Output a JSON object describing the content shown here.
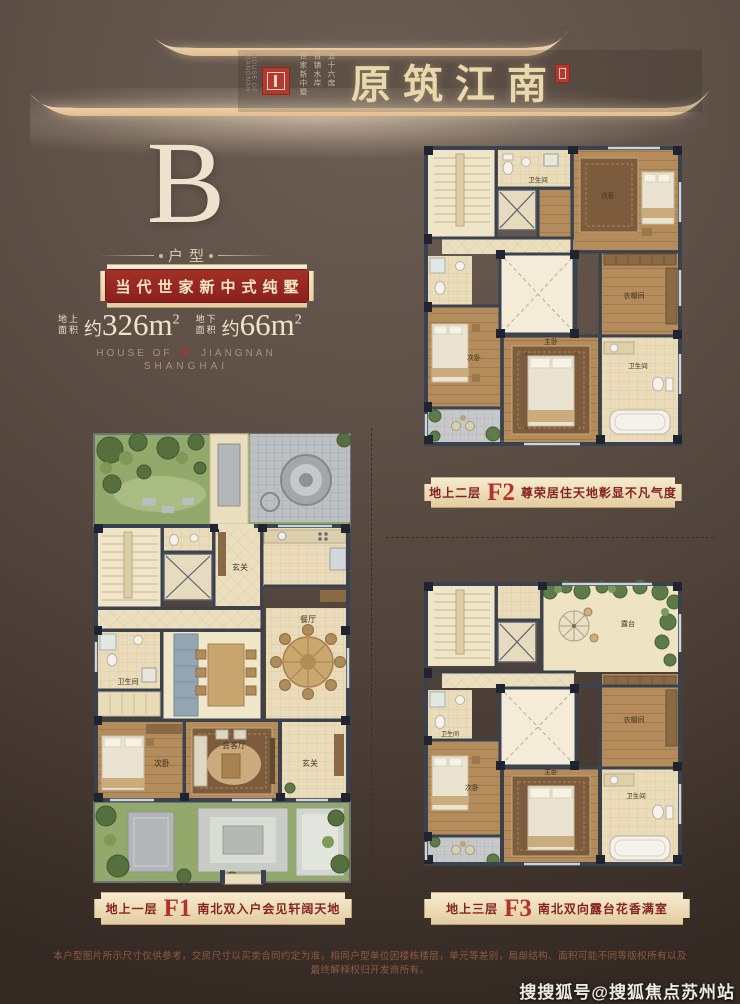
{
  "header": {
    "brand_en_vertical": "HOUSE OF JIANGNAN",
    "tagline_columns": [
      "五十六席",
      "古镇水岸",
      "世家新中墅"
    ],
    "title": "原筑江南"
  },
  "type_section": {
    "letter": "B",
    "label": "户型",
    "slogan": "当代世家新中式纯墅",
    "areas": [
      {
        "label_line1": "地上",
        "label_line2": "面积",
        "prefix": "约",
        "number": "326",
        "unit": "m",
        "sup": "2"
      },
      {
        "label_line1": "地下",
        "label_line2": "面积",
        "prefix": "约",
        "number": "66",
        "unit": "m",
        "sup": "2"
      }
    ],
    "brand_line": {
      "pre": "HOUSE OF",
      "ornament": "❦",
      "post": "JIANGNAN",
      "city": "SHANGHAI"
    }
  },
  "plans": {
    "f2": {
      "rooms": {
        "bath_top": "卫生间",
        "bed_tr": "次卧",
        "closet": "衣帽间",
        "bed_bl": "次卧",
        "bed_bm": "主卧",
        "bath_br": "卫生间"
      }
    },
    "f1": {
      "rooms": {
        "foyer": "玄关",
        "bath": "卫生间",
        "dining": "餐厅",
        "living": "会客厅",
        "bed": "次卧",
        "hall": "玄关"
      }
    },
    "f3": {
      "rooms": {
        "terrace": "露台",
        "bath_l": "卫生间",
        "closet": "衣帽间",
        "bed_bl": "次卧",
        "bed_bm": "主卧",
        "bath_br": "卫生间"
      }
    }
  },
  "captions": {
    "f2": {
      "floor": "地上二层",
      "code": "F2",
      "tagline": "尊荣居住天地彰显不凡气度"
    },
    "f1": {
      "floor": "地上一层",
      "code": "F1",
      "tagline": "南北双入户会见轩阔天地"
    },
    "f3": {
      "floor": "地上三层",
      "code": "F3",
      "tagline": "南北双向露台花香满室"
    }
  },
  "footer": {
    "disclaimer": "本户型图片所示尺寸仅供参考，交房尺寸以买卖合同约定为准，相同户型单位因楼栋楼层，单元等差别，局部结构、面积可能不同等版权所有以及最终解释权归开发商所有。",
    "watermark": "搜搜狐号@搜狐焦点苏州站"
  },
  "colors": {
    "accent_red": "#9a2a26",
    "gold": "#eed9ae",
    "cream_text": "#ece0c8"
  }
}
